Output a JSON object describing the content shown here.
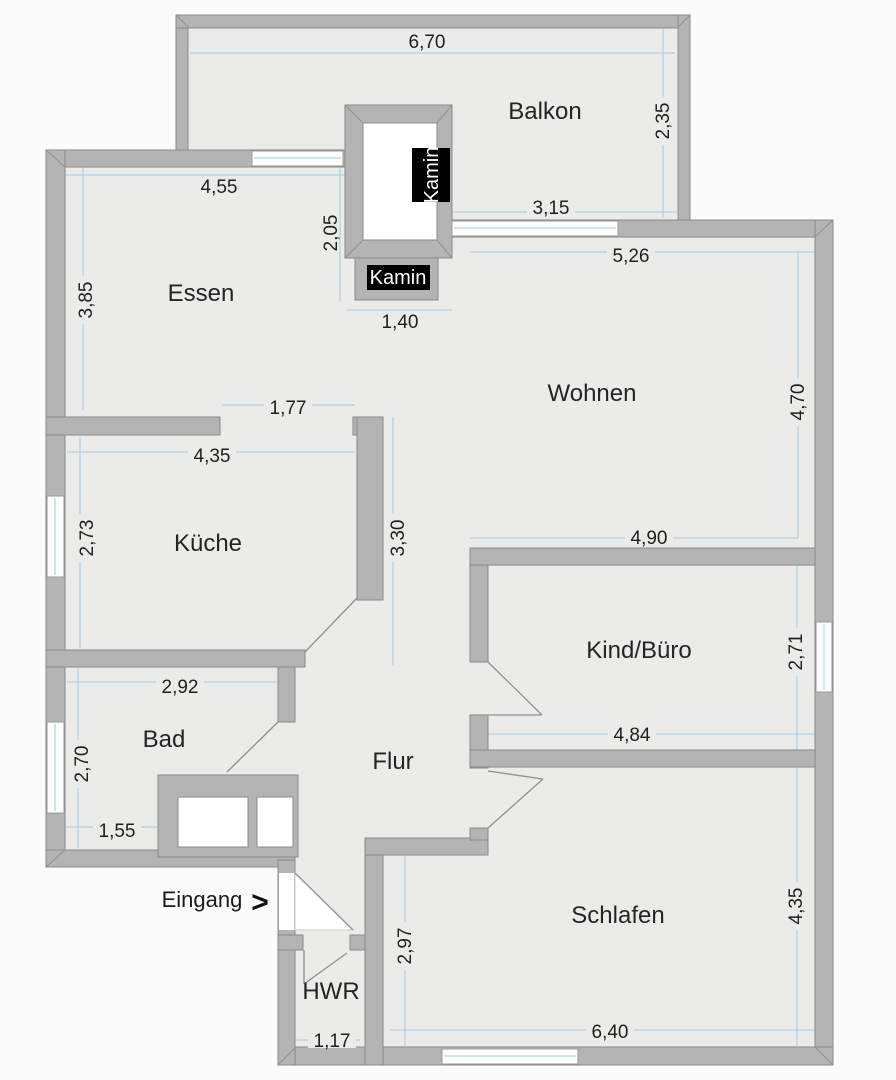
{
  "rooms": {
    "balkon": "Balkon",
    "essen": "Essen",
    "wohnen": "Wohnen",
    "kueche": "Küche",
    "kind_buero": "Kind/Büro",
    "bad": "Bad",
    "flur": "Flur",
    "schlafen": "Schlafen",
    "hwr": "HWR"
  },
  "annotations": {
    "kamin_shaft": "Kamin",
    "kamin_block": "Kamin",
    "eingang": "Eingang",
    "eingang_arrow": ">"
  },
  "dims": {
    "balkon_top": "6,70",
    "balkon_right": "2,35",
    "balkon_inner": "3,15",
    "essen_top": "4,55",
    "essen_left": "3,85",
    "kamin_height": "2,05",
    "kamin_width": "1,40",
    "wohnen_top": "5,26",
    "wohnen_right": "4,70",
    "wohnen_bottom": "4,90",
    "essen_opening": "1,77",
    "kueche_top": "4,35",
    "kueche_left": "2,73",
    "flur_wall": "3,30",
    "kind_buero_right": "2,71",
    "kind_buero_bottom": "4,84",
    "bad_top": "2,92",
    "bad_left": "2,70",
    "bad_bottom": "1,55",
    "schlafen_left": "2,97",
    "schlafen_right": "4,35",
    "schlafen_bottom": "6,40",
    "hwr_bottom": "1,17"
  },
  "colors": {
    "wall": "#b4b4b4",
    "wall_outline": "#8a8a8a",
    "floor": "#ebebea",
    "window": "#fdfdfd",
    "dimension_line": "#a9c7da",
    "label_text": "#1f1f1f",
    "kamin_bg": "#000000",
    "kamin_text": "#ffffff",
    "background": "#fbfbfb"
  }
}
